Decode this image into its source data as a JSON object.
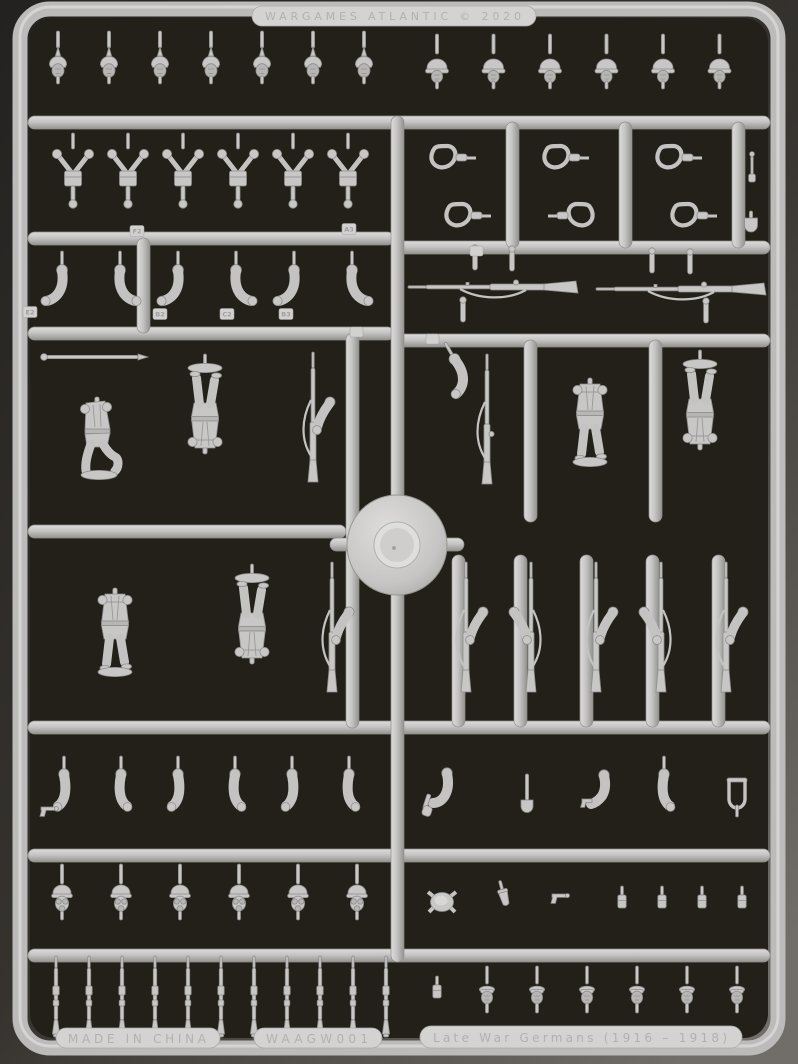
{
  "photo": {
    "subject": "injection-molded plastic sprue of WW1 German infantry miniature parts",
    "plastic_color": "#c8c7c5",
    "backdrop_color": "#2a2724",
    "recess_color": "#232019"
  },
  "embossed": {
    "brand": "WARGAMES ATLANTIC © 2020",
    "made_in": "MADE IN CHINA",
    "sku": "WAAGW001",
    "product": "Late War Germans (1916 – 1918)"
  },
  "part_tags": [
    "F2",
    "A3",
    "E2",
    "B2",
    "C2",
    "B3"
  ],
  "parts": {
    "pickelhaube_heads": 7,
    "stahlhelm_heads": 6,
    "backpack_strap_sets": 6,
    "rifle_slings_top": 3,
    "rifle_slings_bottom": 3,
    "bent_arms_upper": 6,
    "rifles_horizontal": 2,
    "full_bodies_standing": 2,
    "full_bodies_inverted": 3,
    "kneeling_bodies": 1,
    "arms_with_rifles": 5,
    "arms_lower_left": 6,
    "gasmask_heads": 6,
    "ammo_pouches": 4,
    "rifles_bottom": 11,
    "bare_heads": 6
  }
}
